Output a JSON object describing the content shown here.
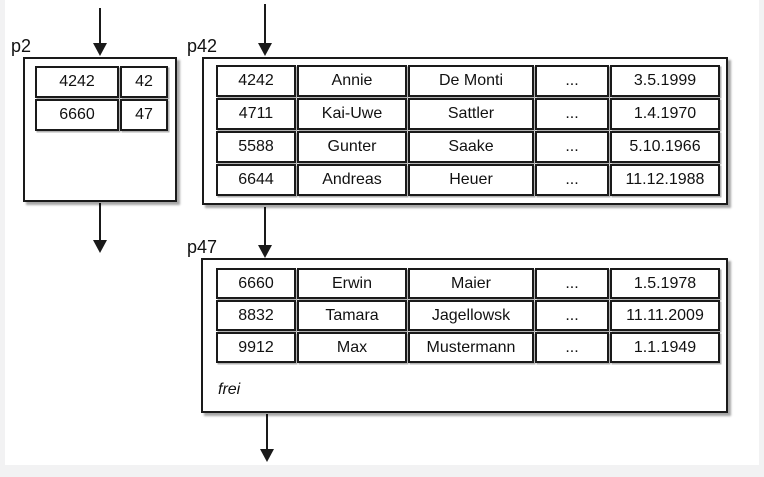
{
  "diagram": {
    "background": "#ffffff",
    "line_color": "#1a1a1a",
    "edge_color": "#f2f2f3",
    "nodes": {
      "p2": {
        "label": "p2",
        "rows": [
          [
            "4242",
            "42"
          ],
          [
            "6660",
            "47"
          ]
        ]
      },
      "p42": {
        "label": "p42",
        "rows": [
          [
            "4242",
            "Annie",
            "De Monti",
            "...",
            "3.5.1999"
          ],
          [
            "4711",
            "Kai-Uwe",
            "Sattler",
            "...",
            "1.4.1970"
          ],
          [
            "5588",
            "Gunter",
            "Saake",
            "...",
            "5.10.1966"
          ],
          [
            "6644",
            "Andreas",
            "Heuer",
            "...",
            "11.12.1988"
          ]
        ]
      },
      "p47": {
        "label": "p47",
        "rows": [
          [
            "6660",
            "Erwin",
            "Maier",
            "...",
            "1.5.1978"
          ],
          [
            "8832",
            "Tamara",
            "Jagellowsk",
            "...",
            "11.11.2009"
          ],
          [
            "9912",
            "Max",
            "Mustermann",
            "...",
            "1.1.1949"
          ]
        ],
        "free_label": "frei"
      }
    }
  }
}
